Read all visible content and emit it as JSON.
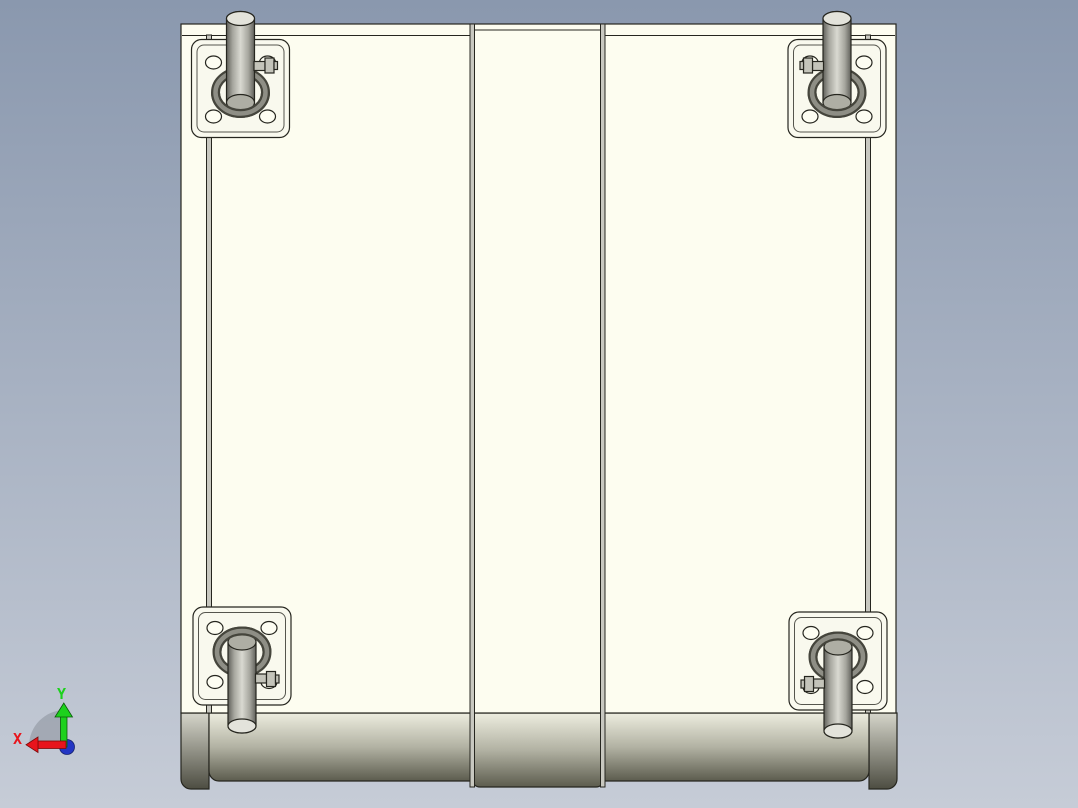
{
  "triad": {
    "x_label": "X",
    "y_label": "Y"
  },
  "colors": {
    "background_top": "#8a98ae",
    "background_bottom": "#c6ccd7",
    "outline": "#26261f",
    "panel": "#fdfdf0",
    "plate": "#f9f9ee",
    "hole": "#fdfdf2",
    "seam": "#c8c8c0",
    "ring_dark": "#45453c",
    "ring_light": "#8e8e85",
    "wheel_edge": "#60605a",
    "wheel_mid": "#a6a69e",
    "wheel_light": "#d9d9d1",
    "cap_far": "#e3e3db",
    "cap_near": "#aeaea4",
    "nut": "#c4c4ba",
    "band_top": "#ededdf",
    "band_mid": "#b2b2a3",
    "band_bottom": "#5c5c4e",
    "strip_top": "#d5d5ca",
    "strip_bottom": "#4d4d42",
    "x_axis": "#e8141c",
    "y_axis": "#1dd11d",
    "origin": "#2336c4",
    "disc": "#9ba1ac"
  }
}
